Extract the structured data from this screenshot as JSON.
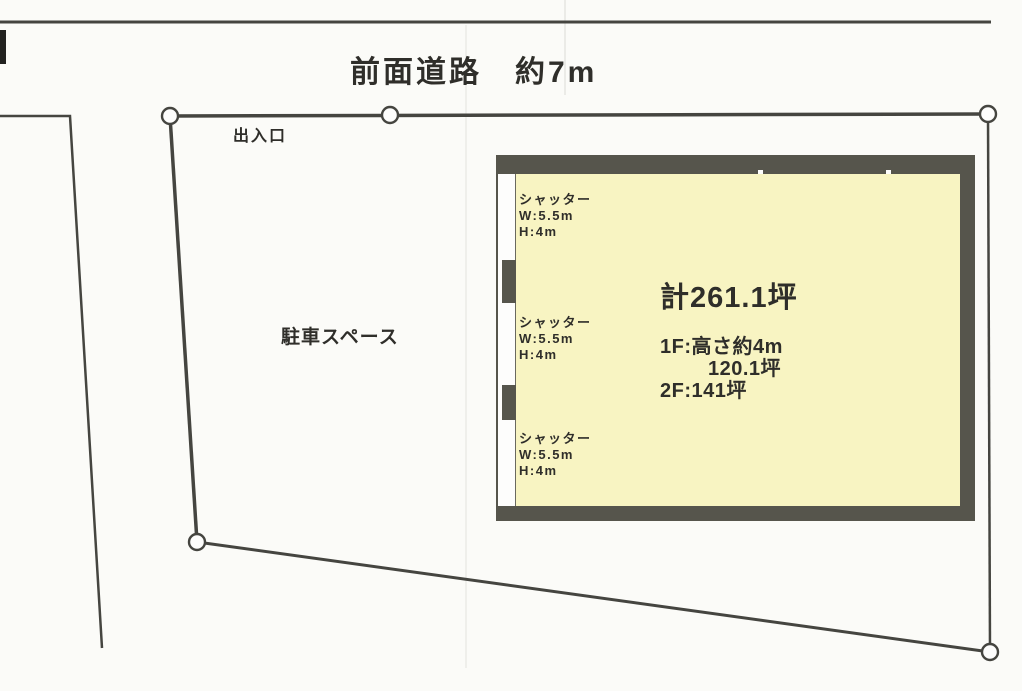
{
  "road": {
    "label": "前面道路　約7m"
  },
  "site": {
    "entrance_label": "出入口",
    "parking_label": "駐車スペース"
  },
  "building": {
    "total_area_label": "計261.1坪",
    "floor_lines": [
      "1F:高さ約4m",
      "120.1坪",
      "2F:141坪"
    ],
    "shutters": [
      {
        "title": "シャッター",
        "width": "W:5.5m",
        "height": "H:4m"
      },
      {
        "title": "シャッター",
        "width": "W:5.5m",
        "height": "H:4m"
      },
      {
        "title": "シャッター",
        "width": "W:5.5m",
        "height": "H:4m"
      }
    ],
    "fill_color": "#f8f4c2",
    "wall_color": "#56554c"
  },
  "colors": {
    "boundary_line": "#454540",
    "text": "#2f2e2a",
    "background": "#fbfbf8"
  }
}
